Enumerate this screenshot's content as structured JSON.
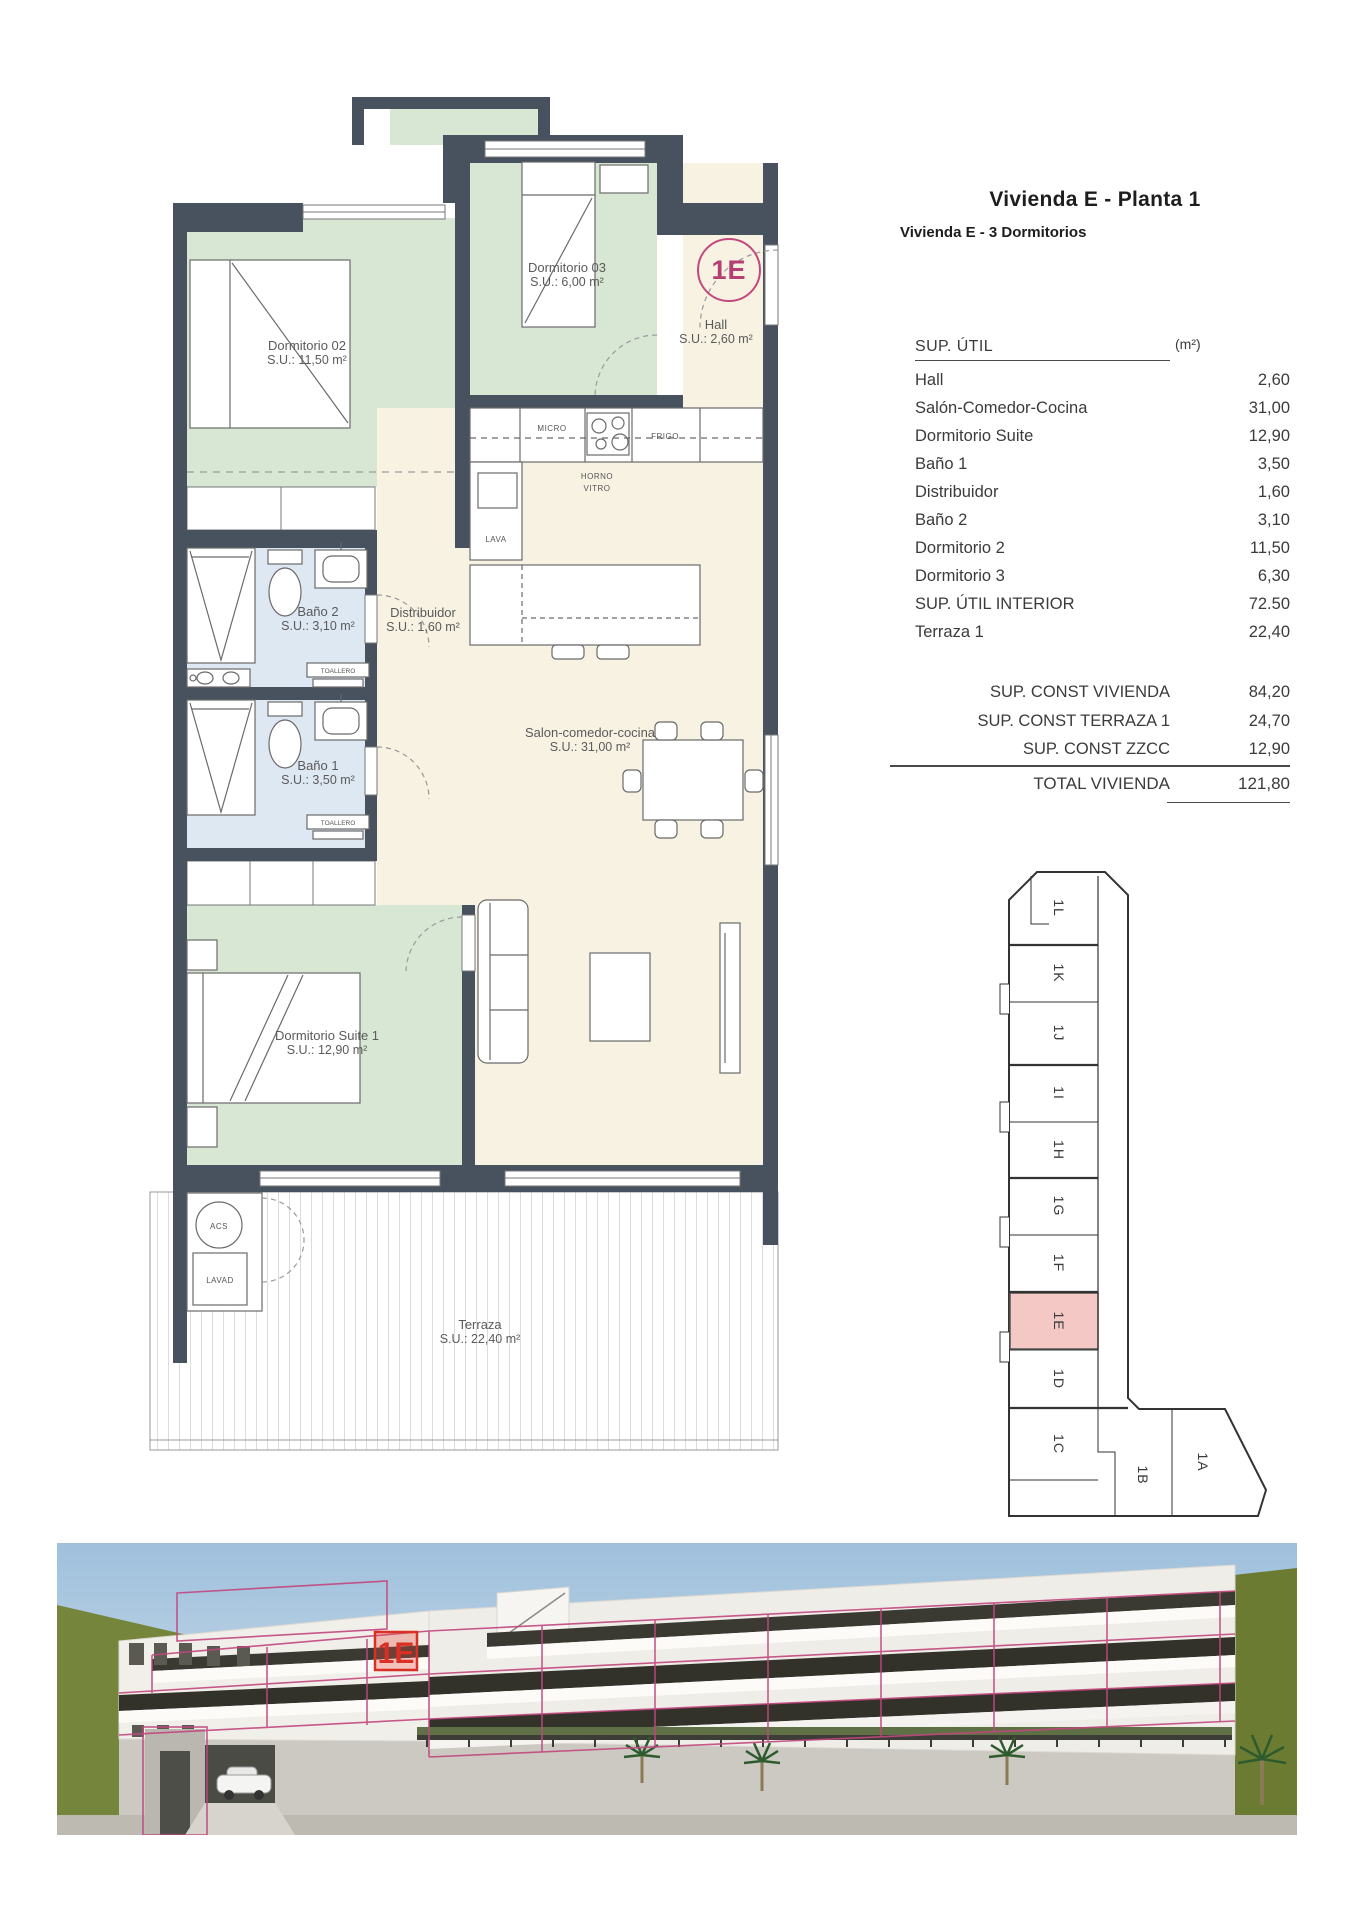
{
  "header": {
    "title": "Vivienda E - Planta 1",
    "subtitle": "Vivienda E - 3 Dormitorios"
  },
  "table": {
    "header": {
      "label": "SUP. ÚTIL",
      "unit": "(m²)"
    },
    "rows": [
      {
        "label": "Hall",
        "value": "2,60"
      },
      {
        "label": "Salón-Comedor-Cocina",
        "value": "31,00"
      },
      {
        "label": "Dormitorio Suite",
        "value": "12,90"
      },
      {
        "label": "Baño 1",
        "value": "3,50"
      },
      {
        "label": "Distribuidor",
        "value": "1,60"
      },
      {
        "label": "Baño 2",
        "value": "3,10"
      },
      {
        "label": "Dormitorio 2",
        "value": "11,50"
      },
      {
        "label": "Dormitorio 3",
        "value": "6,30"
      },
      {
        "label": "SUP. ÚTIL INTERIOR",
        "value": "72.50"
      },
      {
        "label": "Terraza 1",
        "value": "22,40"
      }
    ],
    "summary": [
      {
        "label": "SUP. CONST VIVIENDA",
        "value": "84,20"
      },
      {
        "label": "SUP. CONST TERRAZA 1",
        "value": "24,70"
      },
      {
        "label": "SUP. CONST ZZCC",
        "value": "12,90"
      }
    ],
    "total": {
      "label": "TOTAL VIVIENDA",
      "value": "121,80"
    }
  },
  "plan": {
    "badge": "1E",
    "rooms": {
      "dormitorio02": {
        "name": "Dormitorio 02",
        "area": "S.U.: 11,50 m²"
      },
      "dormitorio03": {
        "name": "Dormitorio 03",
        "area": "S.U.: 6,00 m²"
      },
      "hall": {
        "name": "Hall",
        "area": "S.U.: 2,60 m²"
      },
      "bano2": {
        "name": "Baño 2",
        "area": "S.U.: 3,10 m²"
      },
      "distribuidor": {
        "name": "Distribuidor",
        "area": "S.U.: 1,60 m²"
      },
      "bano1": {
        "name": "Baño 1",
        "area": "S.U.: 3,50 m²"
      },
      "salon": {
        "name": "Salon-comedor-cocina",
        "area": "S.U.: 31,00 m²"
      },
      "suite": {
        "name": "Dormitorio Suite 1",
        "area": "S.U.: 12,90 m²"
      },
      "terraza": {
        "name": "Terraza",
        "area": "S.U.: 22,40 m²"
      }
    },
    "kitchen": {
      "micro": "MICRO",
      "frigo": "FRIGO",
      "horno1": "HORNO",
      "horno2": "VITRO",
      "lava": "LAVA"
    },
    "utility": {
      "acs": "ACS",
      "lavad": "LAVAD"
    },
    "toallero": "TOALLERO"
  },
  "keyplan": {
    "highlighted_unit": "1E",
    "units": [
      {
        "label": "1L"
      },
      {
        "label": "1K"
      },
      {
        "label": "1J"
      },
      {
        "label": "1I"
      },
      {
        "label": "1H"
      },
      {
        "label": "1G"
      },
      {
        "label": "1F"
      },
      {
        "label": "1E"
      },
      {
        "label": "1D"
      },
      {
        "label": "1C"
      },
      {
        "label": "1B"
      },
      {
        "label": "1A"
      }
    ]
  },
  "render": {
    "badge": "1E"
  },
  "colors": {
    "accent_magenta": "#c2477f",
    "highlight_pink": "#f4c8c5",
    "badge_red": "#d93025",
    "wall_dark": "#48525f",
    "room_green": "#d8e7d4",
    "room_cream": "#f8f2e3",
    "room_blue": "#dde8f3"
  }
}
